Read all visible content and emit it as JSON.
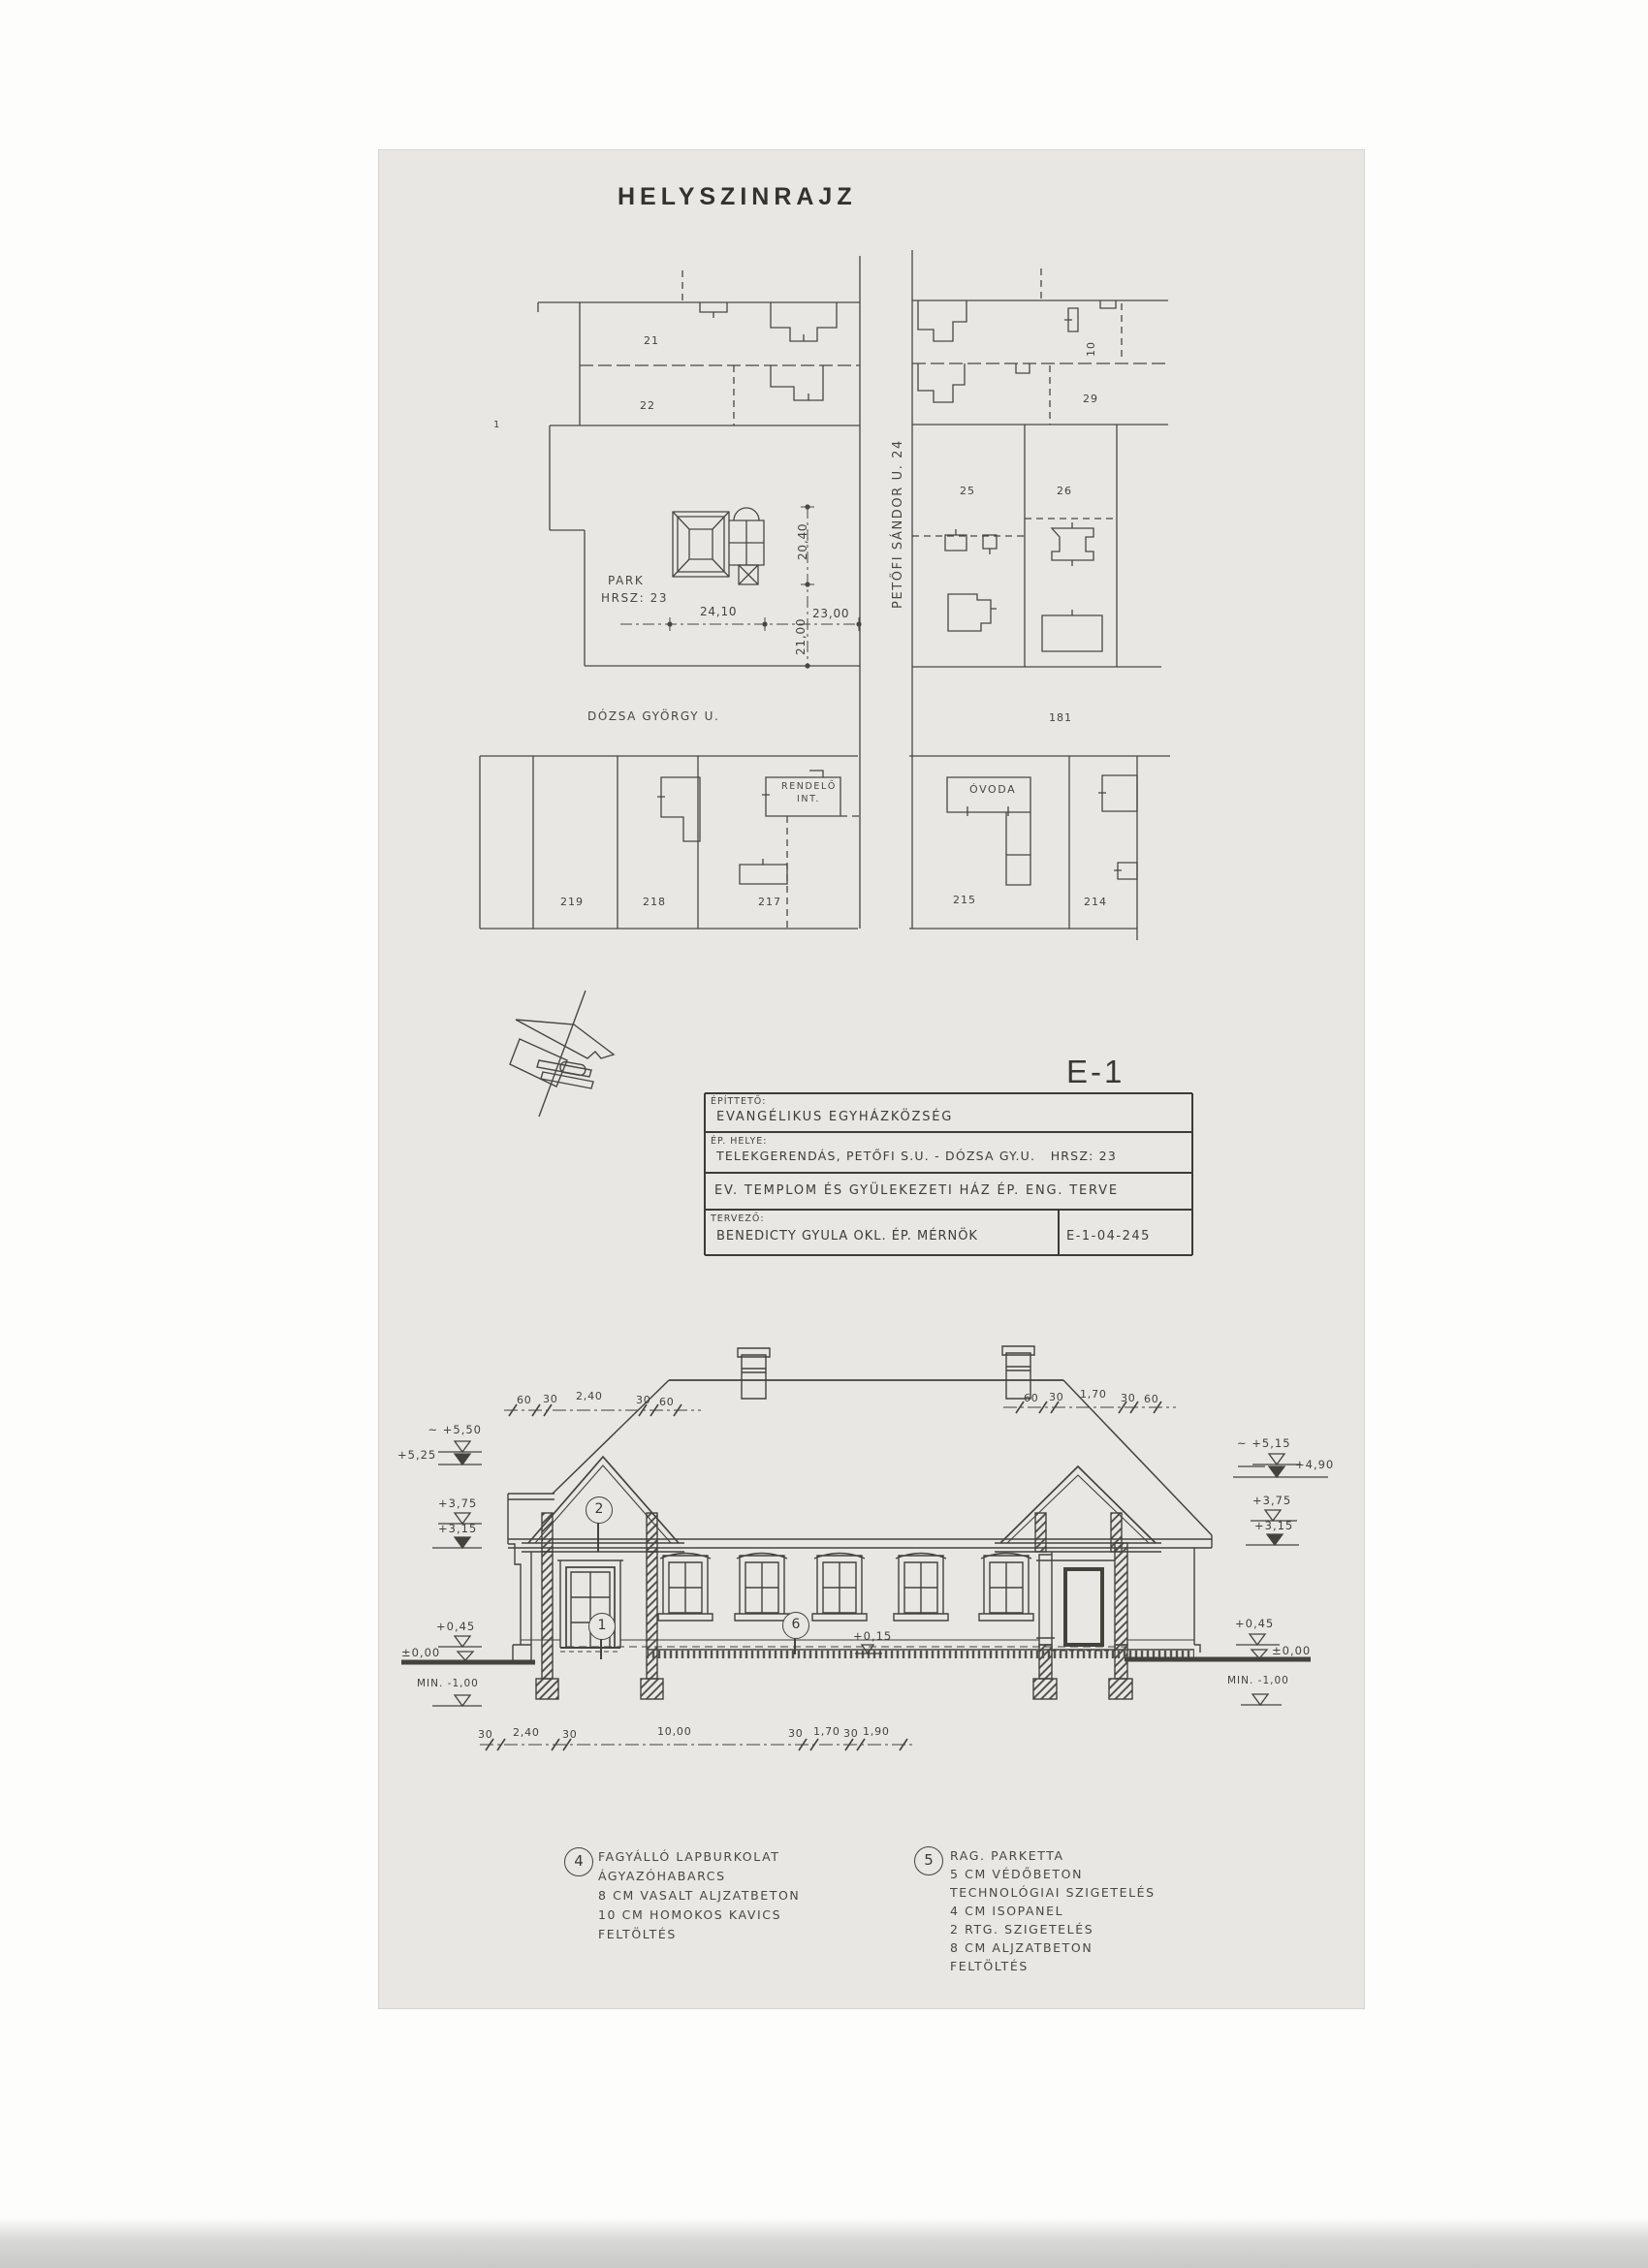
{
  "page": {
    "title": "HELYSZINRAJZ"
  },
  "site_plan": {
    "street_vertical": "PETŐFI SÁNDOR U. 24",
    "street_horizontal": "DÓZSA GYÖRGY U.",
    "block_number": "181",
    "park_line1": "PARK",
    "park_line2": "HRSZ: 23",
    "building_rendelo_line1": "RENDELŐ",
    "building_rendelo_line2": "INT.",
    "building_ovoda": "ÓVODA",
    "plot_labels": {
      "left_edge": "1",
      "left_top": "21",
      "left_mid": "22",
      "right_top": "10",
      "right_mid": "29",
      "right_low_left": "25",
      "right_low_right": "26",
      "south_1": "219",
      "south_2": "218",
      "south_3": "217",
      "south_4": "215",
      "south_5": "214"
    },
    "dimensions": {
      "width_park": "24,10",
      "width_street_block": "23,00",
      "depth_south": "21,00",
      "depth_north": "20,40"
    }
  },
  "title_block": {
    "drawing_no": "E-1",
    "client_label": "ÉPÍTTETŐ:",
    "client": "EVANGÉLIKUS EGYHÁZKÖZSÉG",
    "site_label": "ÉP. HELYE:",
    "site": "TELEKGERENDÁS, PETŐFI S.U. - DÓZSA GY.U.   HRSZ: 23",
    "project": "EV. TEMPLOM ÉS GYÜLEKEZETI HÁZ ÉP. ENG. TERVE",
    "designer_label": "TERVEZŐ:",
    "designer": "BENEDICTY GYULA OKL. ÉP. MÉRNÖK",
    "drawing_code": "E-1-04-245"
  },
  "elevation": {
    "markers_left": [
      "~ +5,50",
      "+5,25",
      "+3,75",
      "+3,15",
      "+0,45",
      "±0,00",
      "MIN. -1,00"
    ],
    "markers_right": [
      "~ +5,15",
      "+4,90",
      "+3,75",
      "+3,15",
      "+0,45",
      "±0,00",
      "MIN. -1,00"
    ],
    "floor_label": "+0,15",
    "callouts": {
      "gable": "2",
      "door": "1",
      "wall": "6"
    },
    "dims_top_left": [
      "60",
      "30",
      "2,40",
      "30",
      "60"
    ],
    "dims_top_right": [
      "60",
      "30",
      "1,70",
      "30",
      "60"
    ],
    "dims_bottom": [
      "30",
      "2,40",
      "30",
      "10,00",
      "30",
      "1,70",
      "30",
      "1,90"
    ]
  },
  "notes": [
    {
      "num": "4",
      "lines": [
        "FAGYÁLLÓ LAPBURKOLAT",
        "ÁGYAZÓHABARCS",
        "8 CM VASALT ALJZATBETON",
        "10 CM HOMOKOS KAVICS",
        "FELTÖLTÉS"
      ]
    },
    {
      "num": "5",
      "lines": [
        "RAG. PARKETTA",
        "5 CM VÉDŐBETON",
        "TECHNOLÓGIAI SZIGETELÉS",
        "4 CM ISOPANEL",
        "2 RTG. SZIGETELÉS",
        "8 CM ALJZATBETON",
        "FELTÖLTÉS"
      ]
    }
  ],
  "colors": {
    "paper": "#e8e7e3",
    "ink": "#45423c",
    "background": "#ffffff"
  }
}
